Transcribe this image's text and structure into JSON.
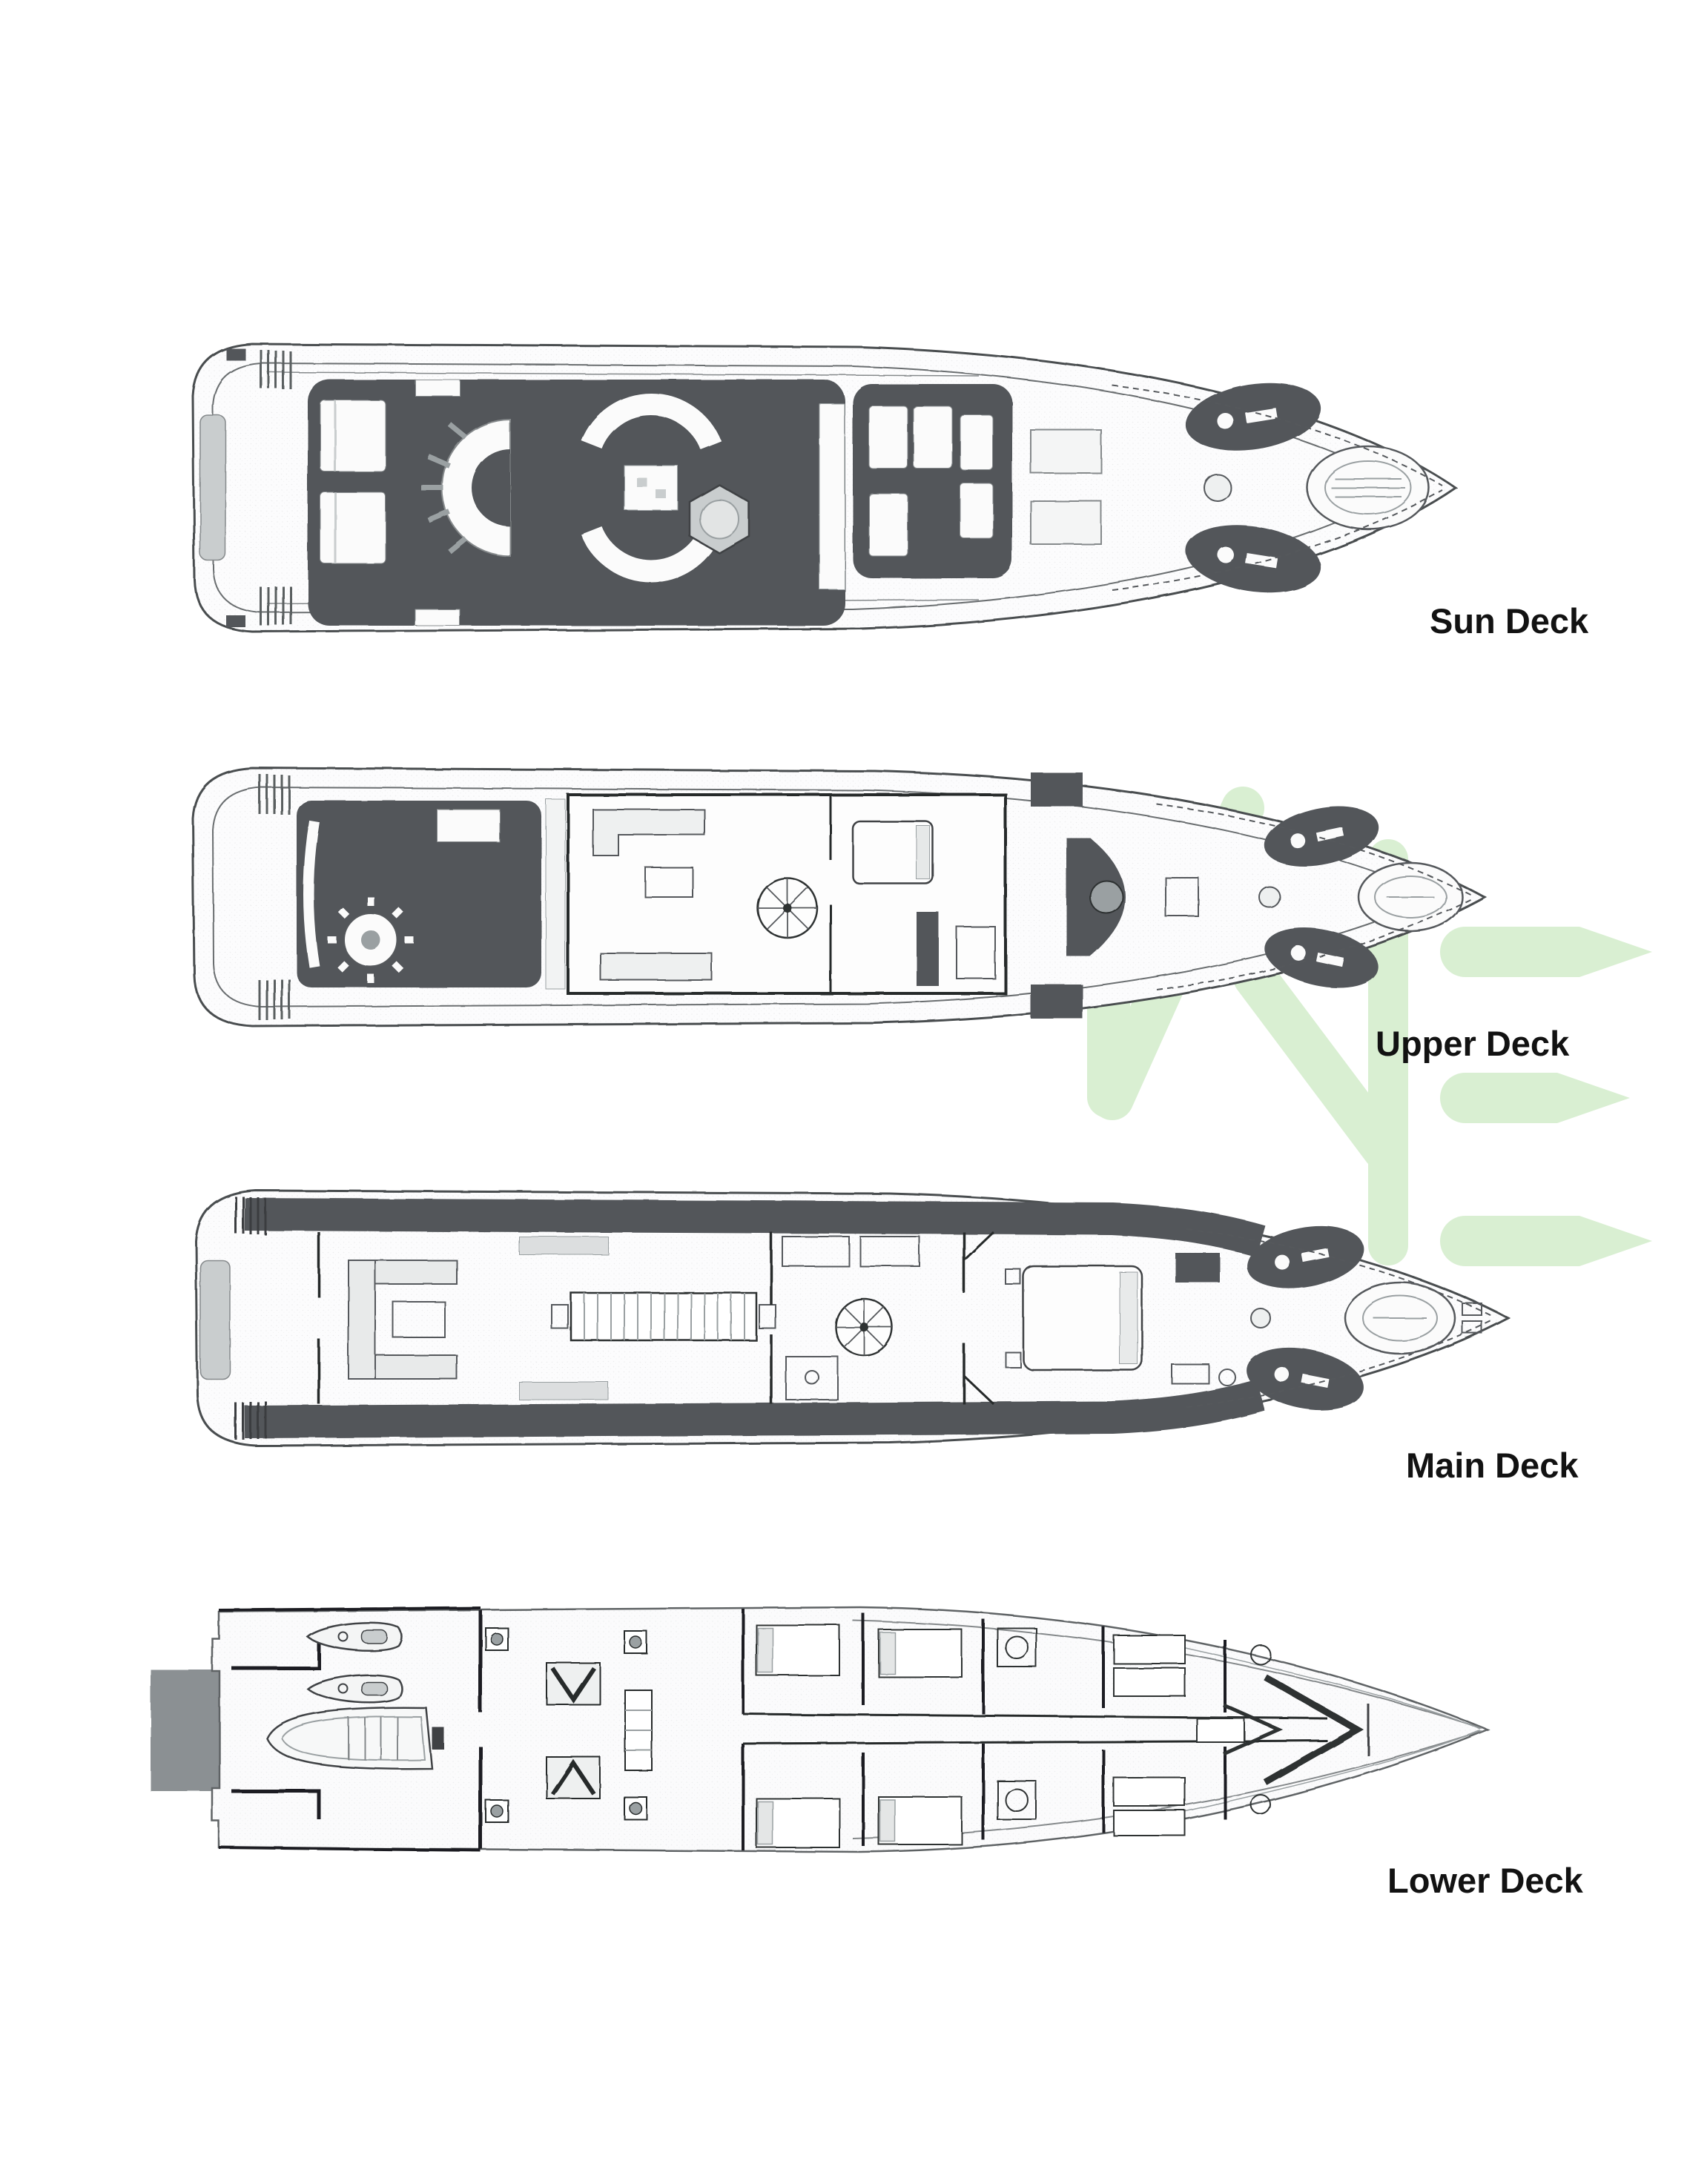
{
  "decks": [
    {
      "id": "sun",
      "label": "Sun Deck"
    },
    {
      "id": "upper",
      "label": "Upper Deck"
    },
    {
      "id": "main",
      "label": "Main Deck"
    },
    {
      "id": "lower",
      "label": "Lower Deck"
    }
  ],
  "watermark": {
    "letters": "ME",
    "color": "#d9efd2"
  },
  "colors": {
    "paper": "#ffffff",
    "ink": "#3f4345",
    "deck_dark": "#53575a",
    "deck_mid": "#9aa0a2",
    "deck_light": "#c9cdce",
    "swim_platform": "#8b9093",
    "label_text": "#121212"
  }
}
